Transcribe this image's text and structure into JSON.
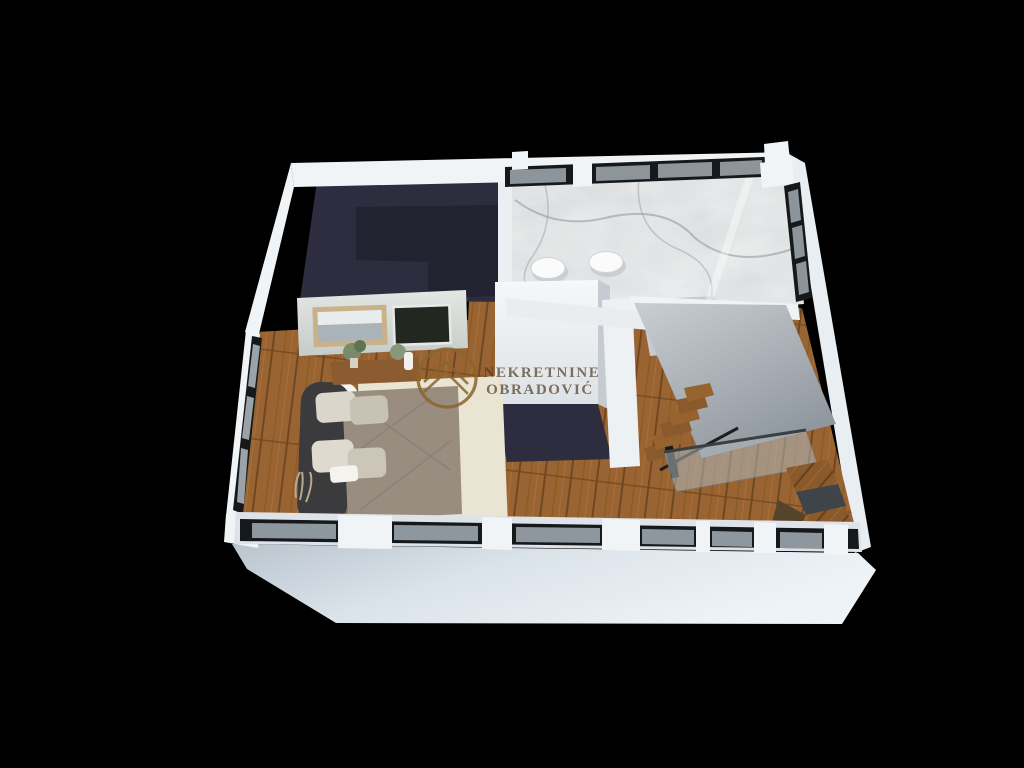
{
  "watermark": {
    "line1": "NEKRETNINE",
    "line2": "OBRADOVIĆ"
  },
  "colors": {
    "background": "#000000",
    "wall_white": "#f1f4f6",
    "wall_shade": "#dde3e8",
    "front_face": "#dfe7ee",
    "navy": "#2e2d3f",
    "navy_shadow": "#232230",
    "wood": "#9a6432",
    "wood_dark": "#7e5126",
    "marble": "#eff1f1",
    "frame_black": "#16191c",
    "glass": "#9aa3a8",
    "gray_wall": "#aab2b9",
    "rug": "#eae4d3",
    "duvet": "#998d80",
    "headboard": "#3b3b3d",
    "pillow_light": "#dad6cb",
    "pillow_dark": "#c7c2b4",
    "gold": "#8a662c",
    "gold_text": "#4d3a1f"
  }
}
